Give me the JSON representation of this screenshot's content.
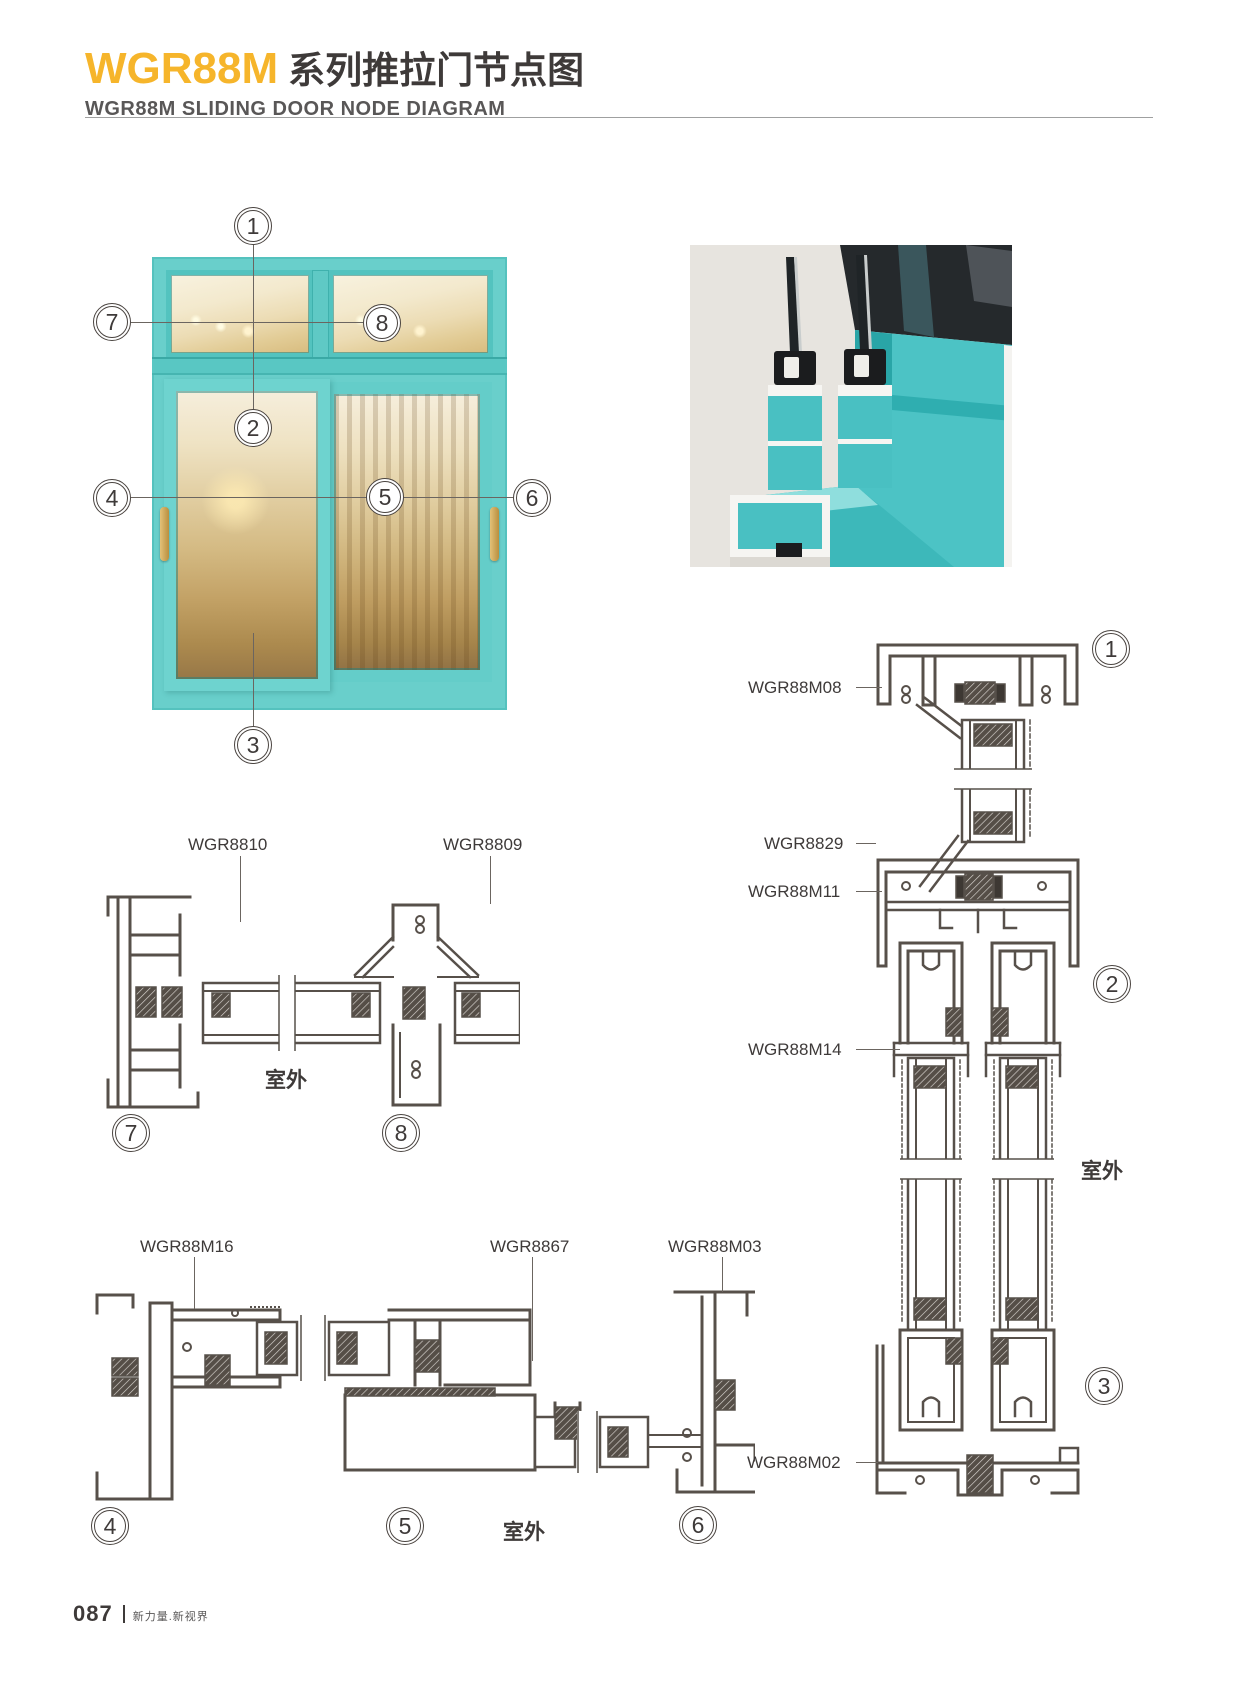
{
  "header": {
    "series_code": "WGR88M",
    "title_cn": "系列推拉门节点图",
    "subtitle_en": "WGR88M SLIDING DOOR NODE DIAGRAM"
  },
  "colors": {
    "accent_yellow": "#F6B52B",
    "title_dark": "#3E3A39",
    "subtitle_gray": "#595757",
    "drawing_line": "#57504A",
    "frame_teal": "#5FC9C5",
    "frame_teal_dark": "#2E9E9B",
    "handle_gold": "#C8A452",
    "render_background": "#E7E4DF"
  },
  "overview_callouts": {
    "c1": "1",
    "c2": "2",
    "c3": "3",
    "c4": "4",
    "c5": "5",
    "c6": "6",
    "c7": "7",
    "c8": "8"
  },
  "details": {
    "d78": {
      "label_left": "WGR8810",
      "label_right": "WGR8809",
      "outdoor": "室外",
      "callout_left": "7",
      "callout_right": "8"
    },
    "d456": {
      "label_1": "WGR88M16",
      "label_2": "WGR8867",
      "label_3": "WGR88M03",
      "outdoor": "室外",
      "callout_1": "4",
      "callout_2": "5",
      "callout_3": "6"
    },
    "d123": {
      "label_1": "WGR88M08",
      "label_2": "WGR8829",
      "label_3": "WGR88M11",
      "label_4": "WGR88M14",
      "label_5": "WGR88M02",
      "outdoor": "室外",
      "callout_1": "1",
      "callout_2": "2",
      "callout_3": "3"
    }
  },
  "footer": {
    "page_number": "087",
    "slogan": "新力量.新视界"
  }
}
